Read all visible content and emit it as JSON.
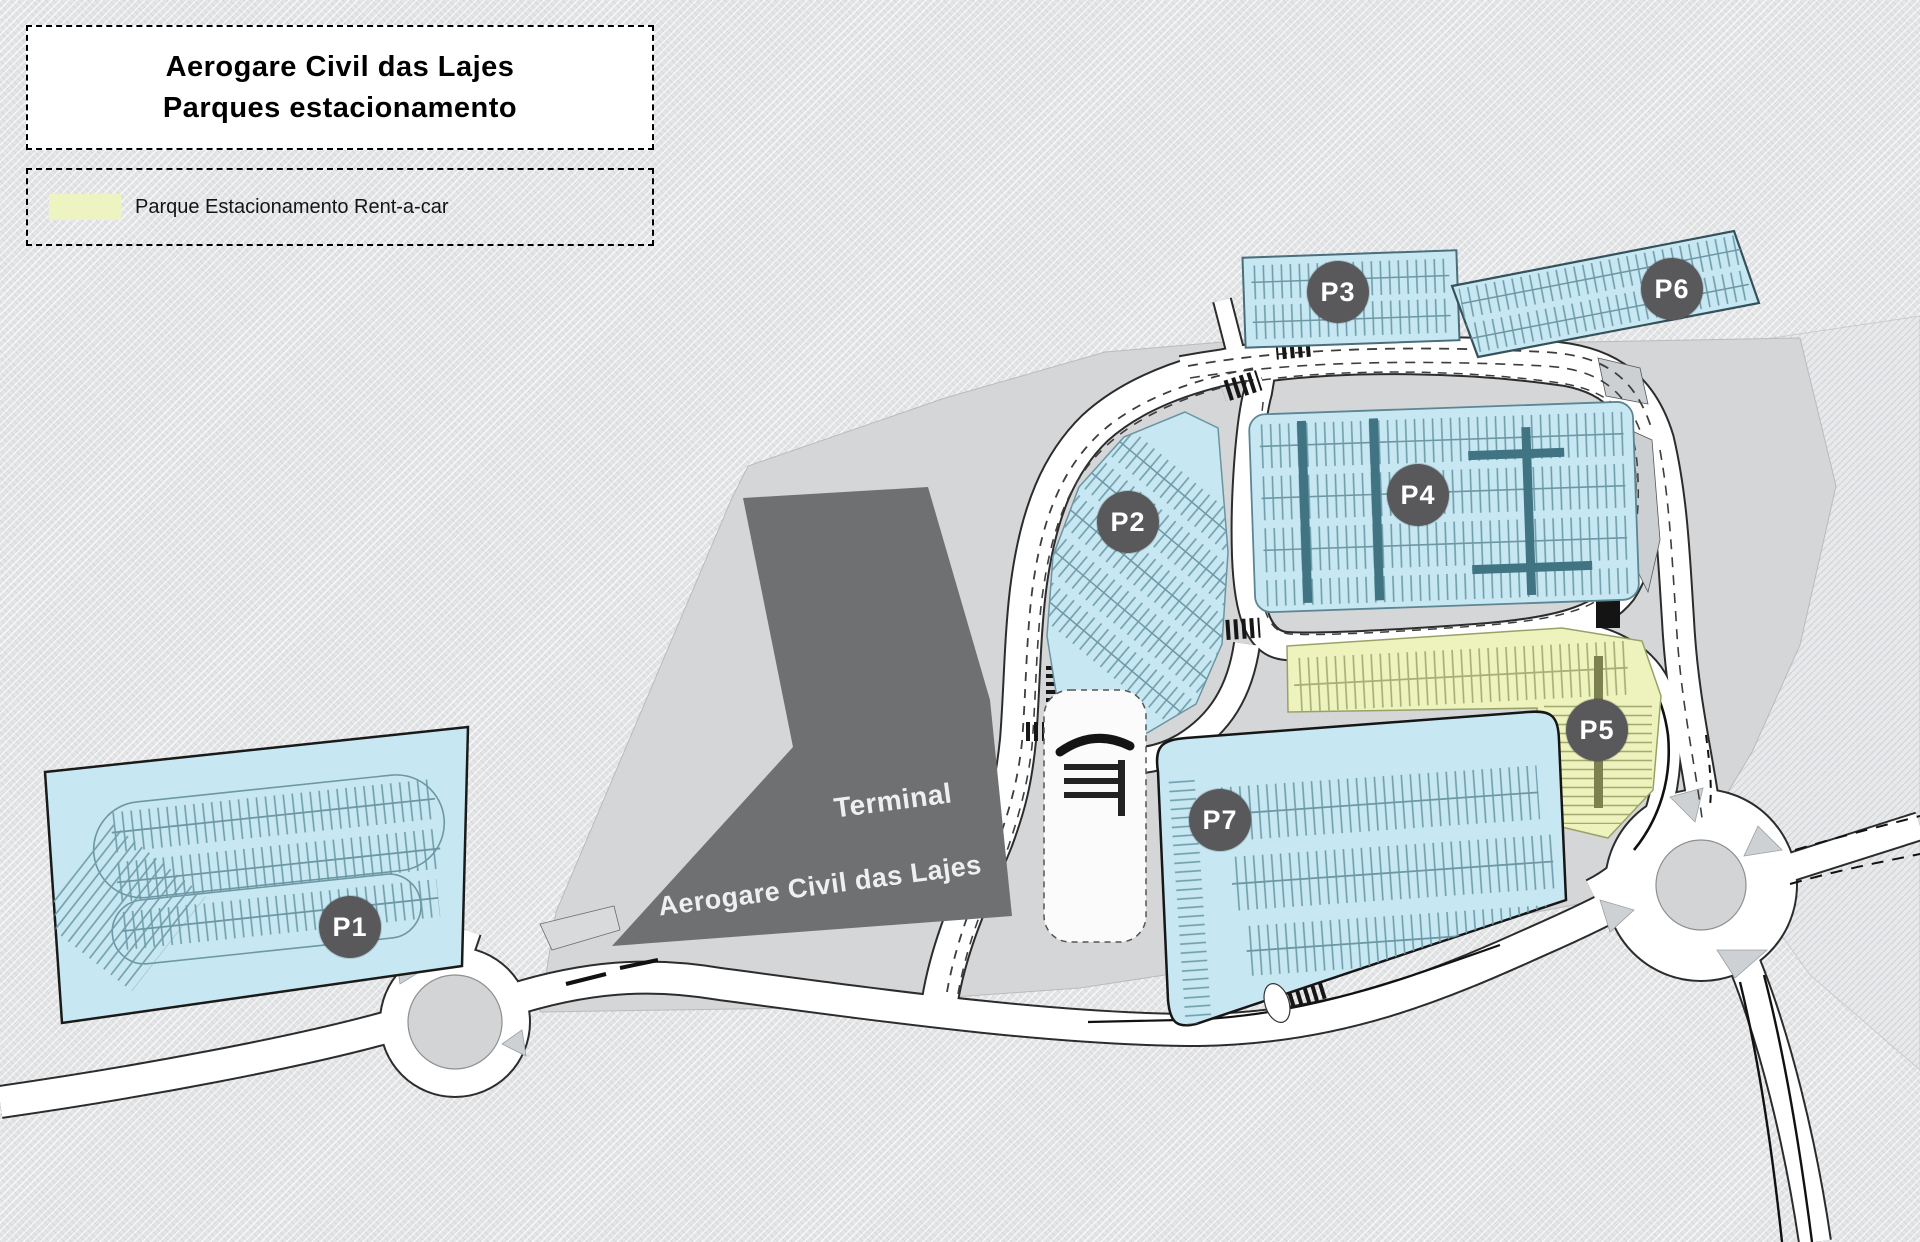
{
  "map_title": {
    "line1": "Aerogare Civil das Lajes",
    "line2": "Parques estacionamento"
  },
  "legend": {
    "items": [
      {
        "swatch_color": "#eef3c2",
        "label": "Parque Estacionamento Rent-a-car"
      }
    ]
  },
  "terminal": {
    "label_line1": "Terminal",
    "label_line2": "Aerogare Civil das Lajes"
  },
  "parking_lots": [
    {
      "id": "P1",
      "category": "public",
      "fill": "#c7e8f2"
    },
    {
      "id": "P2",
      "category": "public",
      "fill": "#c7e8f2"
    },
    {
      "id": "P3",
      "category": "public",
      "fill": "#c7e8f2"
    },
    {
      "id": "P4",
      "category": "public",
      "fill": "#c7e8f2"
    },
    {
      "id": "P5",
      "category": "rent-a-car",
      "fill": "#eef3bd"
    },
    {
      "id": "P6",
      "category": "public",
      "fill": "#c7e8f2"
    },
    {
      "id": "P7",
      "category": "public",
      "fill": "#c7e8f2"
    }
  ],
  "colors": {
    "background": "#e4e5e7",
    "apron": "#d4d6d8",
    "terminal_building": "#6f7072",
    "road": "#ffffff",
    "label_circle": "#59595b",
    "parking_public": "#c7e8f2",
    "parking_rentacar": "#eef3bd"
  }
}
